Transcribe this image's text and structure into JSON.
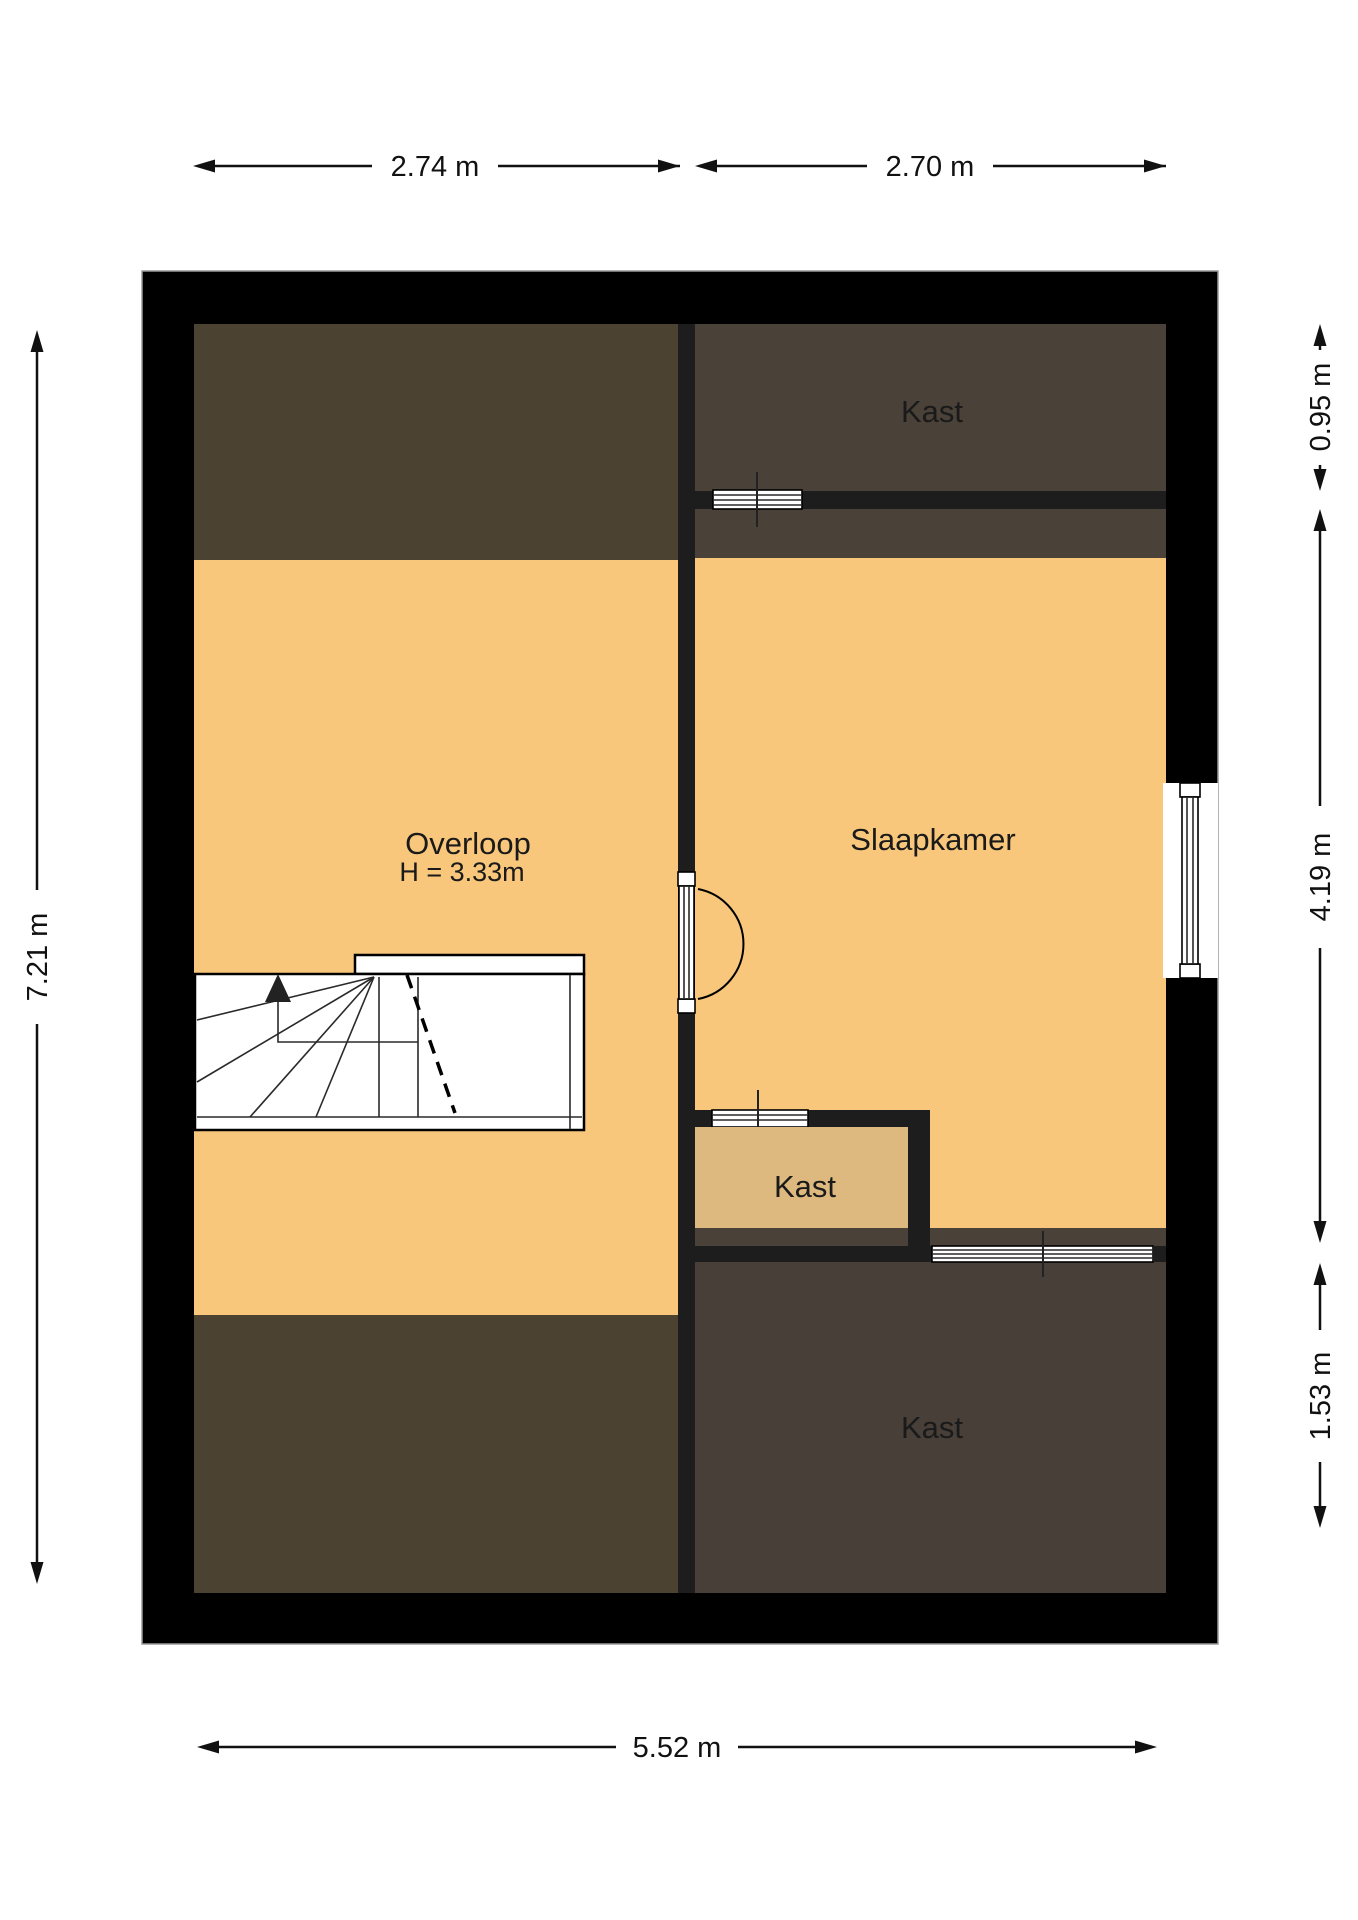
{
  "floorplan": {
    "rooms": {
      "overloop": {
        "label": "Overloop",
        "height_note": "H = 3.33m"
      },
      "slaapkamer": {
        "label": "Slaapkamer"
      },
      "kast_top": {
        "label": "Kast"
      },
      "kast_middle": {
        "label": "Kast"
      },
      "kast_bottom": {
        "label": "Kast"
      }
    },
    "dimensions": {
      "top_left_width": "2.74 m",
      "top_right_width": "2.70 m",
      "left_height": "7.21 m",
      "bottom_width": "5.52 m",
      "right_top": "0.95 m",
      "right_middle": "4.19 m",
      "right_bottom": "1.53 m"
    },
    "colors": {
      "outer_wall": "#000000",
      "inner_wall": "#1d1d1d",
      "floor_orange": "#f8c77c",
      "closet_tan": "#ddb97f",
      "attic_left_brown": "#4b4232",
      "attic_right_brown": "#4a4138",
      "closet_bottom_brown": "#473f38",
      "stair_fill": "#ffffff",
      "dim_text": "#111111"
    }
  }
}
